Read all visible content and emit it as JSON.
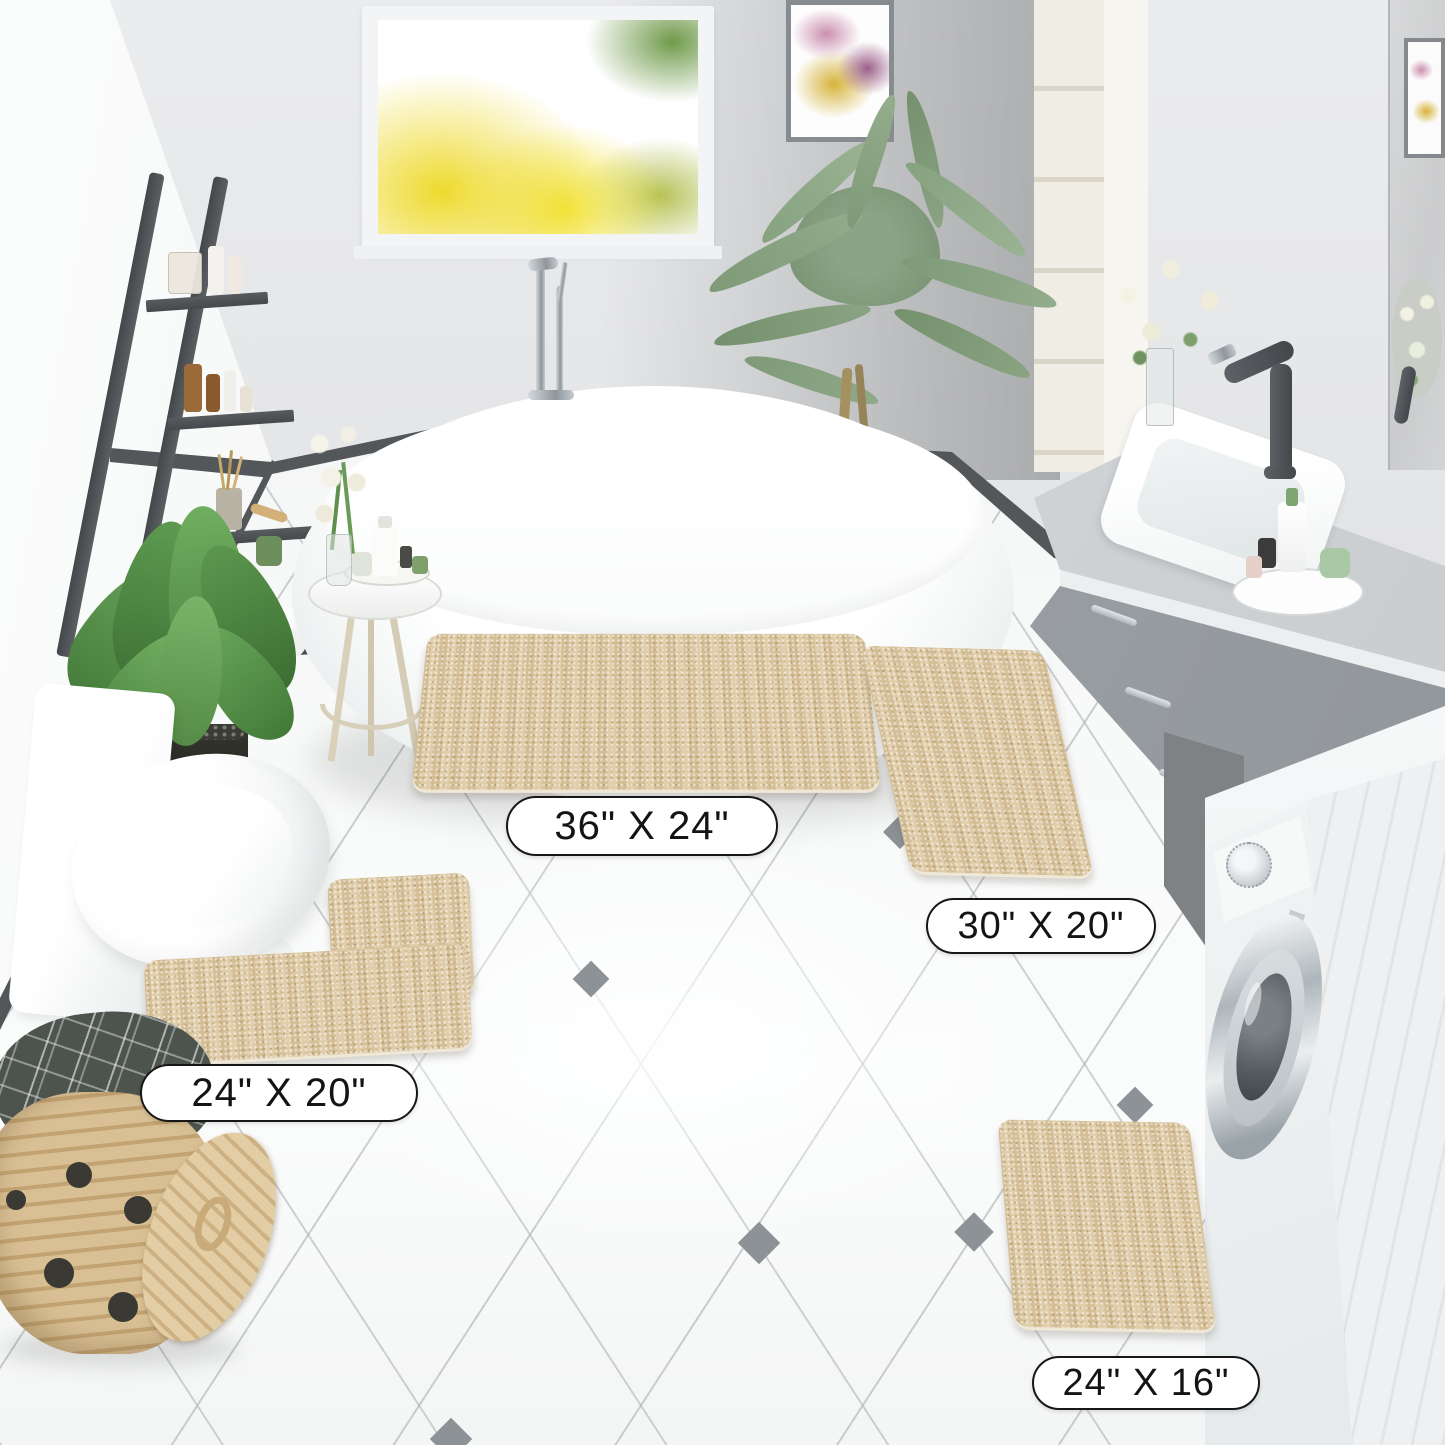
{
  "scene": {
    "description": "3D-rendered bathroom product photo showing a 4-piece beige chenille bath rug set placed on white diagonal-tiled floor among a freestanding tub, vanity with sink, toilet, washing machine, ladder shelf, plants and a wicker laundry basket",
    "objects": [
      "window",
      "wall-art",
      "ladder-shelf",
      "floor-plant",
      "side-table",
      "flower-vase",
      "bathtub",
      "tub-faucet",
      "palm-plant",
      "tall-cabinet",
      "vanity-counter",
      "sink",
      "sink-faucet",
      "mirror",
      "washing-machine",
      "toilet",
      "laundry-basket",
      "bath-towel",
      "large-rug",
      "runner-rug",
      "contour-rug",
      "small-rug"
    ]
  },
  "labels": {
    "rug_large": "36\" X 24\"",
    "rug_runner": "30\" X 20\"",
    "rug_contour": "24\" X 20\"",
    "rug_small": "24\" X 16\""
  },
  "colors": {
    "rug_beige": "#dcc7a0",
    "wall_gray": "#e0e1e3",
    "baseboard_dark": "#53575a",
    "cabinet_gray": "#9aa0a5",
    "floor_white": "#f7f8f8",
    "label_border": "#171717",
    "foliage_green": "#7e9a77",
    "wicker_tan": "#d0b283"
  }
}
